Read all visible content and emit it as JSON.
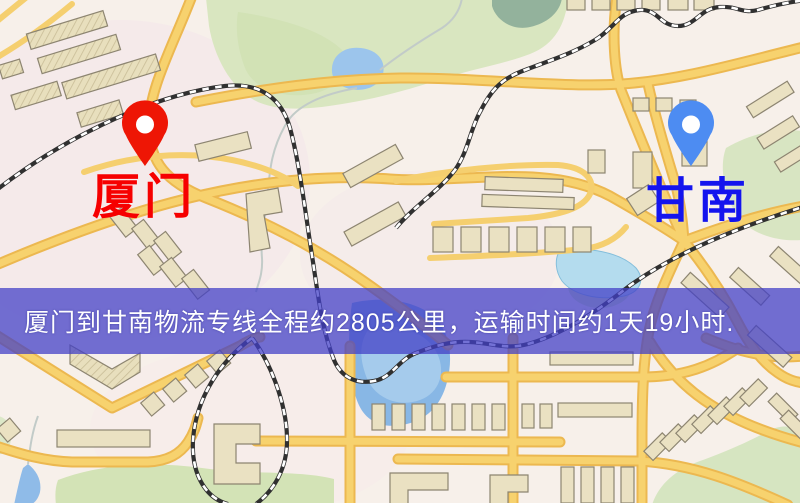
{
  "image_type": "static-logistics-route-map",
  "map": {
    "origin": {
      "label": "厦门",
      "label_color": "#f60000",
      "pin_color": "#ee1605"
    },
    "destination": {
      "label": "甘南",
      "label_color": "#1414ee",
      "pin_color": "#4d8cf2"
    }
  },
  "banner": {
    "text": "厦门到甘南物流专线全程约2805公里，运输时间约1天19小时.",
    "background_color": "rgba(66,64,198,0.74)",
    "text_color": "#ffffff",
    "route": {
      "from": "厦门",
      "to": "甘南",
      "distance_km": 2805,
      "duration": "1天19小时"
    }
  },
  "palette": {
    "map_background": "#f7f0ea",
    "road_fill": "#f7d26e",
    "road_casing": "#ecb850",
    "building_fill": "#eae1c2",
    "building_outline": "#8d8571",
    "park_green": "#d9e6c0",
    "water_blue": "#88b7e5",
    "railway_black": "#303030"
  }
}
